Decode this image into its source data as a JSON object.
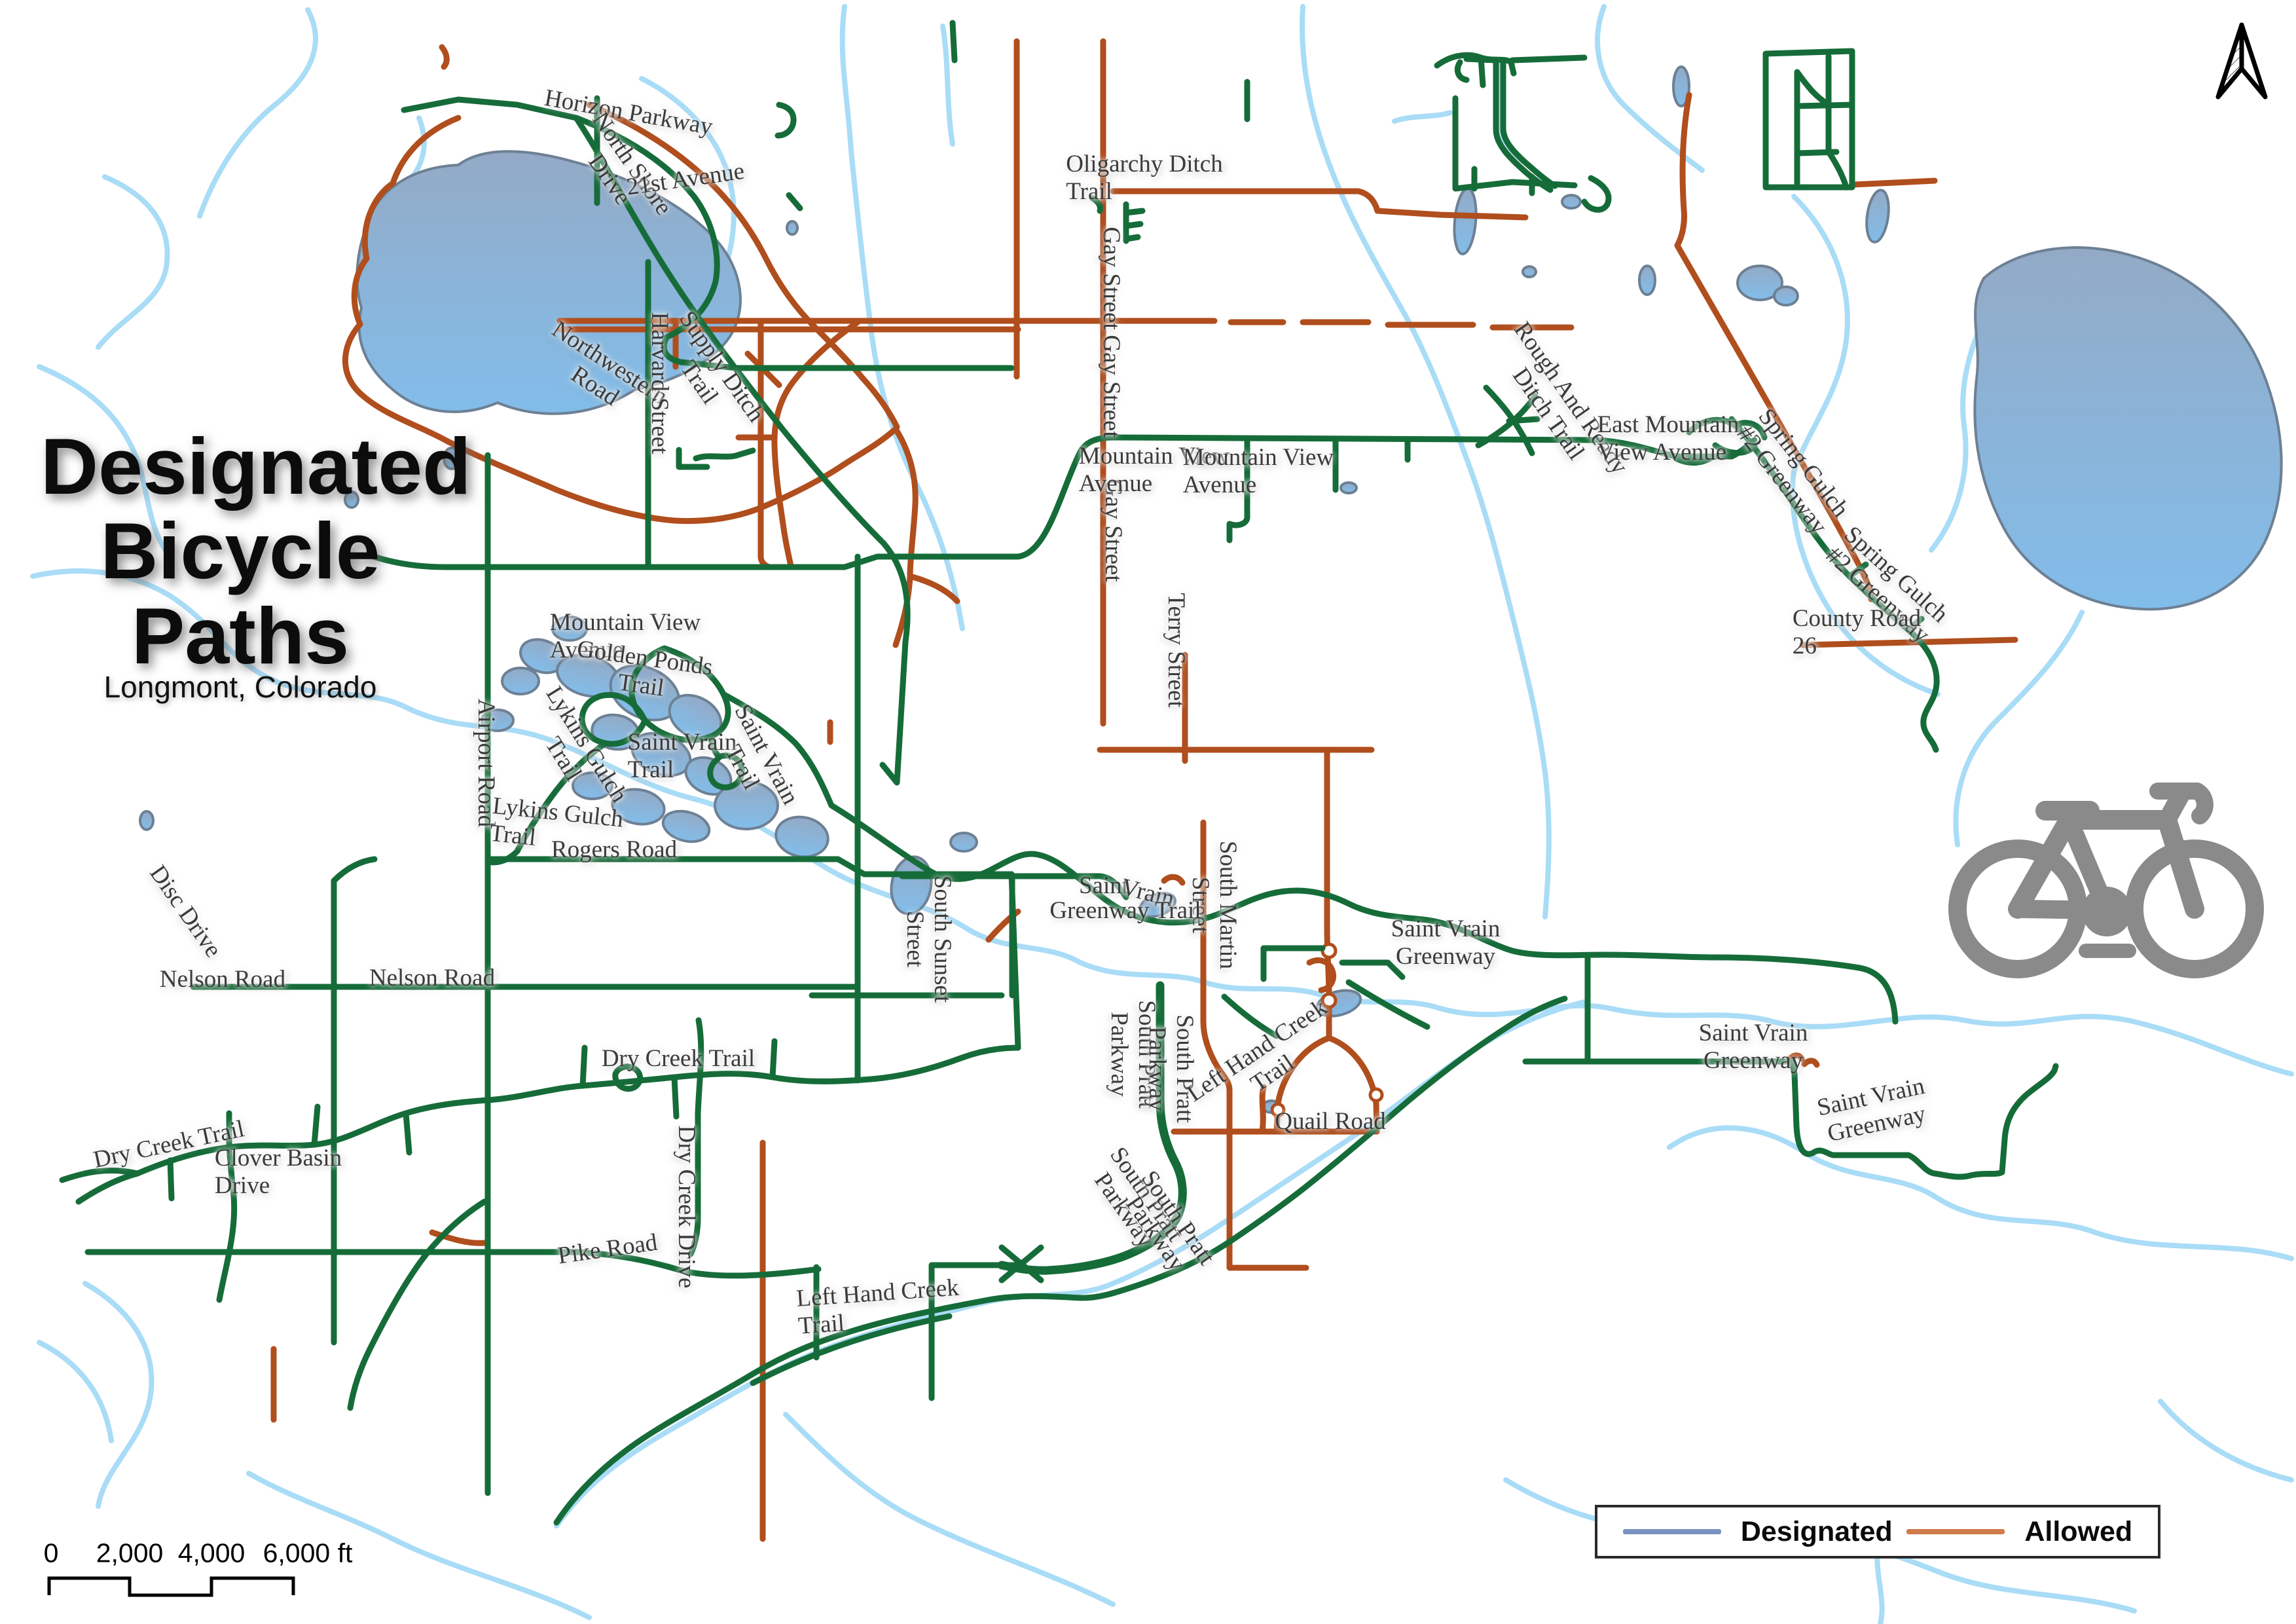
{
  "title": {
    "lines": [
      "Designated",
      "Bicycle",
      "Paths"
    ],
    "subtitle": "Longmont, Colorado"
  },
  "legend": {
    "items": [
      {
        "label": "Designated",
        "color": "#7b93c3"
      },
      {
        "label": "Allowed",
        "color": "#cf7c4b"
      }
    ]
  },
  "scale_bar": {
    "ticks": [
      "0",
      "2,000",
      "4,000",
      "6,000 ft"
    ]
  },
  "colors": {
    "designated_path_on_map": "#166c39",
    "allowed_path_on_map": "#b04e1d",
    "stream": "#a9dcf6",
    "lake_fill_top": "#93aac6",
    "lake_fill_bottom": "#82bdea",
    "lake_stroke": "#6d8094",
    "label_text": "#3b3b3b",
    "bicycle_icon": "#8a8a8a",
    "north_arrow": "#000000"
  },
  "map": {
    "labels": [
      {
        "text": "Horizon Parkway"
      },
      {
        "text": "North Shore\nDrive"
      },
      {
        "text": "21st Avenue"
      },
      {
        "text": "Oligarchy Ditch\nTrail"
      },
      {
        "text": "Gay Street"
      },
      {
        "text": "Gay Street"
      },
      {
        "text": "Gay Street"
      },
      {
        "text": "Rough And Ready\nDitch Trail"
      },
      {
        "text": "Mountain View\nAvenue"
      },
      {
        "text": "Mountain View\nAvenue"
      },
      {
        "text": "Mountain View\nAvenue"
      },
      {
        "text": "East Mountain\nView Avenue"
      },
      {
        "text": "Northwestern\nRoad"
      },
      {
        "text": "Harvard Street"
      },
      {
        "text": "Supply Ditch\nTrail"
      },
      {
        "text": "Golden Ponds\nTrail"
      },
      {
        "text": "Airport Road"
      },
      {
        "text": "Lykins Gulch\nTrail"
      },
      {
        "text": "Saint Vrain\nTrail"
      },
      {
        "text": "Saint Vrain\nTrail"
      },
      {
        "text": "Lykins Gulch\nTrail"
      },
      {
        "text": "Rogers Road"
      },
      {
        "text": "Disc Drive"
      },
      {
        "text": "Nelson Road"
      },
      {
        "text": "Nelson Road"
      },
      {
        "text": "Dry Creek Trail"
      },
      {
        "text": "Clover Basin\nDrive"
      },
      {
        "text": "Pike Road"
      },
      {
        "text": "Dry Creek Drive"
      },
      {
        "text": "Dry Creek Trail"
      },
      {
        "text": "Left Hand Creek\nTrail"
      },
      {
        "text": "South Pratt\nParkway"
      },
      {
        "text": "South Pratt\nParkway"
      },
      {
        "text": "South Pratt\nParkway"
      },
      {
        "text": "South Pratt\nParkway"
      },
      {
        "text": "Left Hand Creek\nTrail"
      },
      {
        "text": "Quail Road"
      },
      {
        "text": "South Martin\nStreet"
      },
      {
        "text": "South Sunset\nStreet"
      },
      {
        "text": "Terry Street"
      },
      {
        "text": "Saint"
      },
      {
        "text": "Vrain"
      },
      {
        "text": "Greenway Trail"
      },
      {
        "text": "Saint Vrain\nGreenway"
      },
      {
        "text": "Saint Vrain\nGreenway"
      },
      {
        "text": "Saint Vrain\nGreenway"
      },
      {
        "text": "Spring Gulch\n#2 Greenway"
      },
      {
        "text": "Spring Gulch\n#2 Greenway"
      },
      {
        "text": "County Road\n26"
      }
    ]
  }
}
